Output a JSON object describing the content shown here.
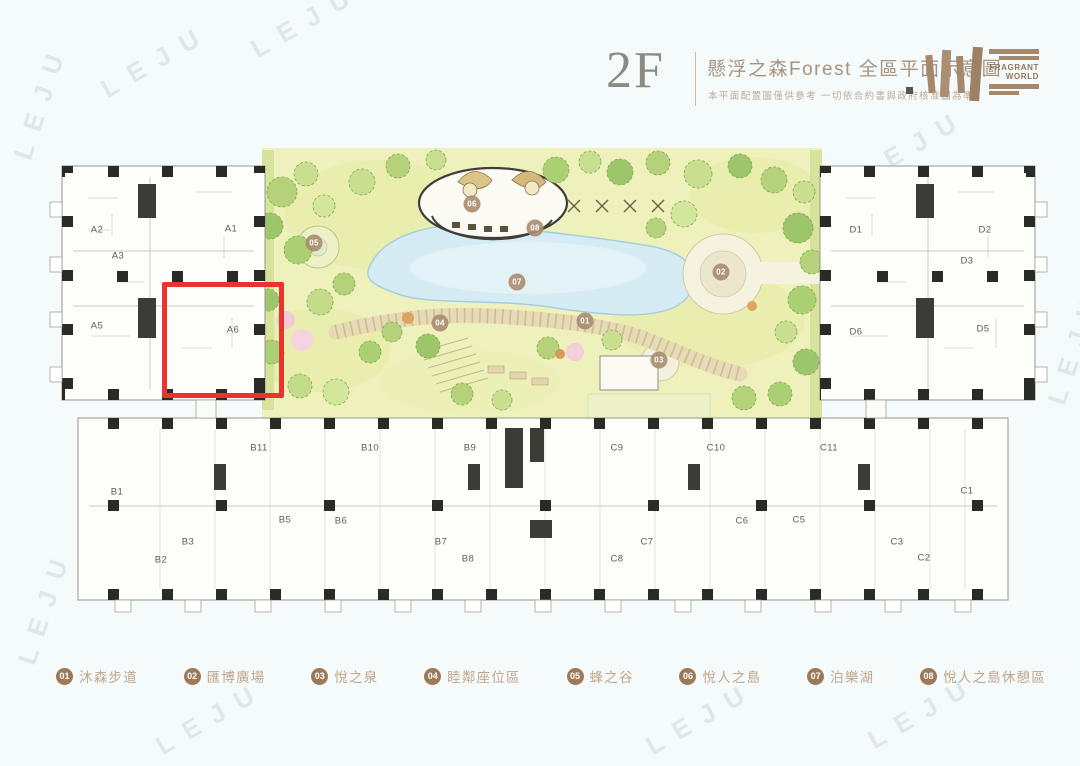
{
  "header": {
    "floor_label": "2F",
    "title": "懸浮之森Forest 全區平面示意圖",
    "disclaimer": "本平面配置圖僅供參考 一切依合約書與政府核准圖為準",
    "brand": {
      "line1": "FRAGRANT",
      "line2": "WORLD"
    }
  },
  "plan": {
    "highlighted_unit": "A6",
    "highlight_color": "#e8332e",
    "units": [
      {
        "label": "A2",
        "x": 97,
        "y": 230
      },
      {
        "label": "A1",
        "x": 231,
        "y": 229
      },
      {
        "label": "A3",
        "x": 118,
        "y": 256
      },
      {
        "label": "A5",
        "x": 97,
        "y": 326
      },
      {
        "label": "A6",
        "x": 233,
        "y": 330
      },
      {
        "label": "D1",
        "x": 856,
        "y": 230
      },
      {
        "label": "D2",
        "x": 985,
        "y": 230
      },
      {
        "label": "D3",
        "x": 967,
        "y": 261
      },
      {
        "label": "D6",
        "x": 856,
        "y": 332
      },
      {
        "label": "D5",
        "x": 983,
        "y": 329
      },
      {
        "label": "B11",
        "x": 259,
        "y": 448
      },
      {
        "label": "B10",
        "x": 370,
        "y": 448
      },
      {
        "label": "B9",
        "x": 470,
        "y": 448
      },
      {
        "label": "B1",
        "x": 117,
        "y": 492
      },
      {
        "label": "B5",
        "x": 285,
        "y": 520
      },
      {
        "label": "B6",
        "x": 341,
        "y": 521
      },
      {
        "label": "B3",
        "x": 188,
        "y": 542
      },
      {
        "label": "B7",
        "x": 441,
        "y": 542
      },
      {
        "label": "B2",
        "x": 161,
        "y": 560
      },
      {
        "label": "B8",
        "x": 468,
        "y": 559
      },
      {
        "label": "C9",
        "x": 617,
        "y": 448
      },
      {
        "label": "C10",
        "x": 716,
        "y": 448
      },
      {
        "label": "C11",
        "x": 829,
        "y": 448
      },
      {
        "label": "C1",
        "x": 967,
        "y": 491
      },
      {
        "label": "C6",
        "x": 742,
        "y": 521
      },
      {
        "label": "C5",
        "x": 799,
        "y": 520
      },
      {
        "label": "C7",
        "x": 647,
        "y": 542
      },
      {
        "label": "C3",
        "x": 897,
        "y": 542
      },
      {
        "label": "C8",
        "x": 617,
        "y": 559
      },
      {
        "label": "C2",
        "x": 924,
        "y": 558
      }
    ],
    "markers": [
      {
        "num": "01",
        "x": 585,
        "y": 321
      },
      {
        "num": "02",
        "x": 721,
        "y": 272
      },
      {
        "num": "03",
        "x": 659,
        "y": 360
      },
      {
        "num": "04",
        "x": 440,
        "y": 323
      },
      {
        "num": "05",
        "x": 314,
        "y": 243
      },
      {
        "num": "06",
        "x": 472,
        "y": 204
      },
      {
        "num": "07",
        "x": 517,
        "y": 282
      },
      {
        "num": "08",
        "x": 535,
        "y": 228
      }
    ]
  },
  "legend": {
    "items": [
      {
        "num": "01",
        "label": "沐森步道"
      },
      {
        "num": "02",
        "label": "匯博廣場"
      },
      {
        "num": "03",
        "label": "悅之泉"
      },
      {
        "num": "04",
        "label": "睦鄰座位區"
      },
      {
        "num": "05",
        "label": "蜂之谷"
      },
      {
        "num": "06",
        "label": "悅人之島"
      },
      {
        "num": "07",
        "label": "泊樂湖"
      },
      {
        "num": "08",
        "label": "悅人之島休憩區"
      }
    ]
  },
  "watermark": {
    "text": "LEJU",
    "positions": [
      {
        "x": 95,
        "y": 45,
        "r": -30
      },
      {
        "x": 245,
        "y": 5,
        "r": -30
      },
      {
        "x": -20,
        "y": 85,
        "r": -72
      },
      {
        "x": -16,
        "y": 590,
        "r": -72
      },
      {
        "x": 852,
        "y": 130,
        "r": -30
      },
      {
        "x": 640,
        "y": 388,
        "r": -30
      },
      {
        "x": 150,
        "y": 702,
        "r": -30
      },
      {
        "x": 640,
        "y": 702,
        "r": -30
      },
      {
        "x": 862,
        "y": 696,
        "r": -30
      },
      {
        "x": 1014,
        "y": 330,
        "r": -72
      }
    ]
  }
}
